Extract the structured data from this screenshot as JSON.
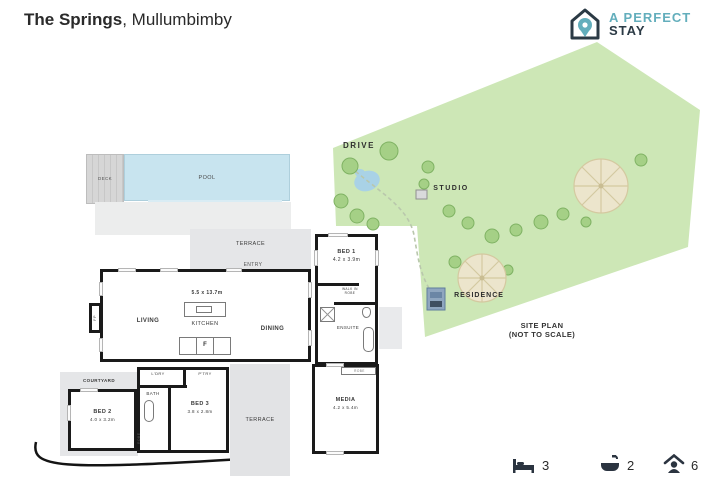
{
  "header": {
    "title_bold": "The Springs",
    "title_rest": ", Mullumbimby"
  },
  "logo": {
    "line1": "A PERFECT",
    "line2": "STAY",
    "teal": "#63aebc",
    "navy": "#2b3a45"
  },
  "floorplan": {
    "deck": "DECK",
    "pool": "POOL",
    "terrace_top": "TERRACE",
    "entry": "ENTRY",
    "living": "LIVING",
    "living_dim": "5.5 x 13.7m",
    "kitchen": "KITCHEN",
    "fridge": "F",
    "fireplace": "FP",
    "dining": "DINING",
    "bed1": "BED 1",
    "bed1_dim": "4.2 x 3.9m",
    "walk_in_robe": "WALK IN ROBE",
    "ensuite": "ENSUITE",
    "courtyard": "COURTYARD",
    "bed2": "BED 2",
    "bed2_dim": "4.0 x 3.2m",
    "bath": "BATH",
    "robe_side": "ROBE",
    "laundry": "L'DRY",
    "pantry": "P'TRY",
    "bed3": "BED 3",
    "bed3_dim": "3.8 x 2.8m",
    "terrace_bottom": "TERRACE",
    "media": "MEDIA",
    "media_dim": "4.2 x 5.4m",
    "media_robe": "ROBE",
    "pool_color": "#c8e4ef",
    "gray_color": "#e5e6e8"
  },
  "siteplan": {
    "drive": "DRIVE",
    "studio": "STUDIO",
    "residence": "RESIDENCE",
    "caption_line1": "SITE PLAN",
    "caption_line2": "(NOT TO SCALE)",
    "land_color": "#cde7b6",
    "tree_color": "#a5d086"
  },
  "stats": {
    "bedrooms": "3",
    "bathrooms": "2",
    "guests": "6",
    "icon_color": "#2b3440"
  }
}
